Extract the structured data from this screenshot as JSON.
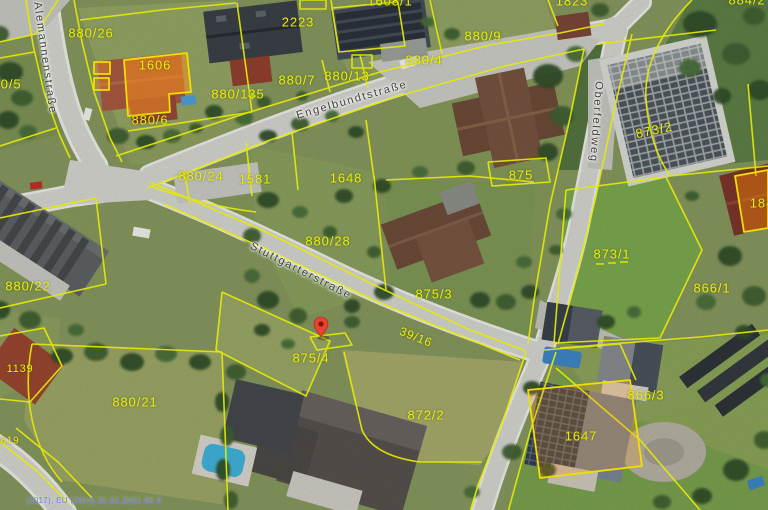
{
  "attribution": "(2017), EU (2014) 31.01.2021 3K 8",
  "marker": {
    "kind": "location-pin",
    "color": "#e8432f",
    "x": 321,
    "y": 337
  },
  "colors": {
    "parcel_line": "#e4ea08",
    "parcel_text": "#e9ef0a",
    "highlight_fill": "rgba(255,140,0,0.45)",
    "street_text": "#3e3e3e"
  },
  "streets": [
    {
      "name": "Alemannenstraße",
      "x": 45,
      "y": 58,
      "rot": 82
    },
    {
      "name": "Engelbundtstraße",
      "x": 352,
      "y": 100,
      "rot": -16
    },
    {
      "name": "Stuttgarterstraße",
      "x": 301,
      "y": 271,
      "rot": 27
    },
    {
      "name": "Oberfeldweg",
      "x": 596,
      "y": 122,
      "rot": 94
    }
  ],
  "parcels": [
    {
      "id": "880/26",
      "x": 91,
      "y": 33
    },
    {
      "id": "880/5",
      "x": 3,
      "y": 84
    },
    {
      "id": "1606",
      "x": 155,
      "y": 65
    },
    {
      "id": "880/6",
      "x": 150,
      "y": 120
    },
    {
      "id": "880/135",
      "x": 238,
      "y": 94
    },
    {
      "id": "2223",
      "x": 298,
      "y": 22
    },
    {
      "id": "1608/1",
      "x": 390,
      "y": 1
    },
    {
      "id": "880/9",
      "x": 483,
      "y": 36
    },
    {
      "id": "880/4",
      "x": 424,
      "y": 60
    },
    {
      "id": "880/7",
      "x": 297,
      "y": 80
    },
    {
      "id": "880/13",
      "x": 347,
      "y": 76
    },
    {
      "id": "880/24",
      "x": 201,
      "y": 176
    },
    {
      "id": "1581",
      "x": 255,
      "y": 179
    },
    {
      "id": "1648",
      "x": 346,
      "y": 178
    },
    {
      "id": "880/28",
      "x": 328,
      "y": 241
    },
    {
      "id": "875/3",
      "x": 434,
      "y": 294
    },
    {
      "id": "875",
      "x": 521,
      "y": 175
    },
    {
      "id": "873/2",
      "x": 654,
      "y": 130,
      "rot": -12
    },
    {
      "id": "873/1",
      "x": 612,
      "y": 254
    },
    {
      "id": "866/1",
      "x": 712,
      "y": 288
    },
    {
      "id": "184",
      "x": 762,
      "y": 203
    },
    {
      "id": "880/22",
      "x": 28,
      "y": 286
    },
    {
      "id": "880/21",
      "x": 135,
      "y": 402
    },
    {
      "id": "1139",
      "x": 20,
      "y": 369,
      "size": 11
    },
    {
      "id": "619",
      "x": 10,
      "y": 441,
      "size": 10
    },
    {
      "id": "875/4",
      "x": 311,
      "y": 358
    },
    {
      "id": "872/2",
      "x": 426,
      "y": 415
    },
    {
      "id": "39/16",
      "x": 416,
      "y": 337,
      "rot": 22,
      "size": 12
    },
    {
      "id": "866/3",
      "x": 646,
      "y": 395
    },
    {
      "id": "1647",
      "x": 581,
      "y": 436
    },
    {
      "id": "884/2",
      "x": 747,
      "y": 0
    },
    {
      "id": "1823",
      "x": 572,
      "y": 1
    }
  ]
}
